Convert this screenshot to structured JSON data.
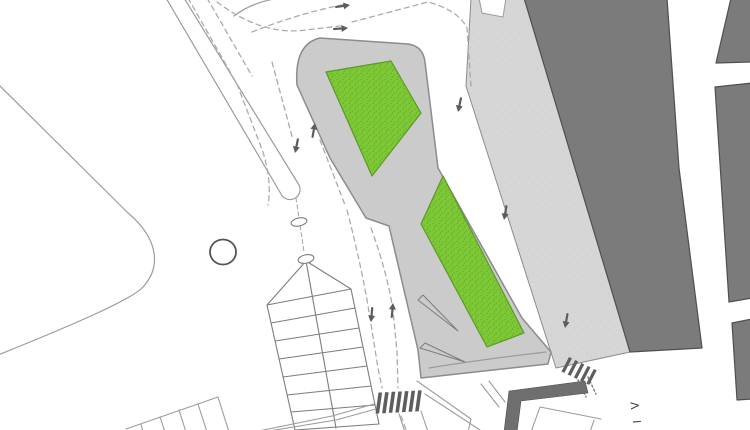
{
  "canvas": {
    "width": 750,
    "height": 430,
    "background": "#ffffff"
  },
  "labels": {
    "street_label": "VI"
  },
  "palette": {
    "white": "#ffffff",
    "plaza_gray": "#d6d6d6",
    "plaza_dot": "#c8c8c8",
    "island_gray": "#cbcbcb",
    "building_dark": "#7b7b7b",
    "building_edge": "#4f4f4f",
    "band_dark": "#6f6f6f",
    "green": "#7cc836",
    "green_stipple": "#68ad27",
    "green_edge": "#5c9a26",
    "line_gray": "#9c9c9c",
    "line_dark": "#7d7d7d",
    "outline_gray": "#8c8c8c",
    "dash_gray": "#ababab",
    "arrow_dark": "#5c5c5c",
    "stripe_dark": "#5e5e5e",
    "text_dark": "#3c3c3c"
  },
  "svg_elements": [
    {
      "name": "plaza-pavement",
      "type": "path",
      "d": "M 471,-2 L 527,-2 L 630,352 L 556,368 L 466,86 Z",
      "fill": "url(#plazafill)",
      "stroke": "@outline_gray",
      "width": 1
    },
    {
      "name": "plaza-top-notch",
      "type": "path",
      "d": "M 479,-2 L 482,13 L 503,17 L 506,-2 Z",
      "fill": "#ffffff",
      "stroke": "@line_gray",
      "width": 1
    },
    {
      "name": "building-main",
      "type": "path",
      "d": "M 524,-2 L 667,-2 L 679,168 L 702,348 L 630,352 Z",
      "fill": "@building_dark",
      "stroke": "@building_edge",
      "width": 1.2
    },
    {
      "name": "building-northeast",
      "type": "path",
      "d": "M 731,-2 L 752,-2 L 752,62 L 716,63 Z",
      "fill": "@building_dark",
      "stroke": "@building_edge",
      "width": 1.2
    },
    {
      "name": "building-east",
      "type": "path",
      "d": "M 715,87 L 752,83 L 752,298 L 729,302 Z",
      "fill": "@building_dark",
      "stroke": "@building_edge",
      "width": 1.2
    },
    {
      "name": "building-southeast",
      "type": "path",
      "d": "M 732,323 L 752,319 L 752,399 L 737,400 Z",
      "fill": "@building_dark",
      "stroke": "@building_edge",
      "width": 1.2
    },
    {
      "name": "traffic-island",
      "type": "path",
      "d": "M 320,38 L 408,44 Q 423,46 425,62 L 438,168 L 522,318 L 551,352 L 548,364 L 421,378 L 418,350 L 389,226 L 366,218 L 330,158 L 297,85 Q 294,44 320,38 Z",
      "fill": "@island_gray",
      "stroke": "@outline_gray",
      "width": 1.5
    },
    {
      "name": "green-area-upper",
      "type": "path",
      "d": "M 326,72 L 391,61 L 421,113 L 372,176 Z",
      "fill": "url(#greenfill)",
      "stroke": "@green_edge",
      "width": 1.2
    },
    {
      "name": "green-area-lower",
      "type": "path",
      "d": "M 443,176 L 421,224 L 487,347 L 524,333 Z",
      "fill": "url(#greenfill)",
      "stroke": "@green_edge",
      "width": 1.2
    },
    {
      "name": "plaza-curb-line",
      "type": "path",
      "d": "M 429,368 Q 478,360 546,352",
      "stroke": "@line_gray",
      "width": 1.2
    },
    {
      "name": "ramp-wedge-upper",
      "type": "path",
      "d": "M 418,300 L 423,295 L 458,331 Z",
      "stroke": "@line_dark",
      "width": 1
    },
    {
      "name": "ramp-wedge-lower",
      "type": "path",
      "d": "M 420,348 L 425,343 L 465,362 Z",
      "stroke": "@line_dark",
      "width": 1
    },
    {
      "name": "road-edge-finger",
      "type": "path",
      "d": "M -2,84 L 127,212 C 158,238 162,266 143,287 C 132,299 80,322 -2,355",
      "stroke": "@line_gray",
      "width": 1.2
    },
    {
      "name": "median-strip",
      "type": "path",
      "d": "M 166,-2 L 281,194 A 9.5,9.5 0 0 0 299,185 L 184,-2",
      "fill": "#ffffff",
      "stroke": "@line_gray",
      "width": 1.2
    },
    {
      "name": "road-corner-arc",
      "type": "path",
      "d": "M 234,16 Q 252,2 280,-2",
      "stroke": "@line_gray",
      "width": 1.2
    },
    {
      "name": "lane-dashed-left-outer",
      "type": "path",
      "d": "M 188,-2 L 237,84 L 263,152 Q 272,182 268,205",
      "stroke": "@dash_gray",
      "width": 1.3,
      "dash": "5 4"
    },
    {
      "name": "lane-dashed-left-inner",
      "type": "path",
      "d": "M 207,-2 L 252,76",
      "stroke": "@dash_gray",
      "width": 1.3,
      "dash": "5 4"
    },
    {
      "name": "turn-dashed-upper",
      "type": "path",
      "d": "M 252,32 Q 292,16 332,7 L 346,4",
      "stroke": "@dash_gray",
      "width": 1.3,
      "dash": "5 4"
    },
    {
      "name": "turn-dashed-lower",
      "type": "path",
      "d": "M 217,2 Q 262,36 306,30 L 340,26",
      "stroke": "@dash_gray",
      "width": 1.3,
      "dash": "5 4"
    },
    {
      "name": "top-right-dashed",
      "type": "path",
      "d": "M 352,22 L 428,2 Q 458,10 467,28 L 471,86",
      "stroke": "@dash_gray",
      "width": 1.3,
      "dash": "5 4"
    },
    {
      "name": "contraflow-dashed-down",
      "type": "path",
      "d": "M 272,62 L 293,140",
      "stroke": "@dash_gray",
      "width": 1.3,
      "dash": "5 4"
    },
    {
      "name": "contraflow-dashed-up",
      "type": "path",
      "d": "M 320,140 L 345,205",
      "stroke": "@dash_gray",
      "width": 1.3,
      "dash": "5 4"
    },
    {
      "name": "island-lane-dashed-down",
      "type": "path",
      "d": "M 347,210 Q 362,268 369,312 L 378,368 L 382,388",
      "stroke": "@dash_gray",
      "width": 1.3,
      "dash": "5 4"
    },
    {
      "name": "island-lane-dashed-up",
      "type": "path",
      "d": "M 371,228 Q 387,272 393,310 L 397,352 L 398,388",
      "stroke": "@dash_gray",
      "width": 1.3,
      "dash": "5 4"
    },
    {
      "name": "below-crosswalk-dashed",
      "type": "path",
      "d": "M 401,416 L 407,432",
      "stroke": "@dash_gray",
      "width": 1.3,
      "dash": "5 4"
    },
    {
      "name": "stairs-axis-dashed",
      "type": "path",
      "d": "M 296,198 L 304,252",
      "stroke": "@dash_gray",
      "width": 1.1,
      "dash": "4 3"
    },
    {
      "name": "small-crosswalk-dotted-a",
      "type": "path",
      "d": "M 578,380 L 586,397",
      "stroke": "@line_dark",
      "width": 1.4,
      "dash": "2 2.5"
    },
    {
      "name": "small-crosswalk-dotted-b",
      "type": "path",
      "d": "M 588,377 L 596,394",
      "stroke": "@line_dark",
      "width": 1.4,
      "dash": "2 2.5"
    },
    {
      "name": "stairs-structure",
      "type": "path",
      "d": "M 267,305 L 295,430 M 351,289 L 379,424 M 306,261 L 267,305 M 306,261 L 351,289 M 306,261 L 336,428 M 267,305 L 351,289 M 271,323 L 355,308 M 275,341 L 359,328 M 279,359 L 363,347 M 283,377 L 367,366 M 287,395 L 371,386 M 291,412 L 375,405 M 295,430 L 379,424",
      "stroke": "@line_dark",
      "width": 1.1
    },
    {
      "name": "parking-stalls",
      "type": "path",
      "d": "M 126,429 L 218,397 L 229,432 M 141,424 L 143,432 M 160,417 L 165,432 M 179,410 L 186,432 M 198,404 L 207,432",
      "stroke": "@line_gray",
      "width": 1.1
    },
    {
      "name": "road-edges-southwest",
      "type": "path",
      "d": "M 254,432 L 332,416 L 374,404 M 263,432 L 336,420 L 376,409",
      "stroke": "@line_gray",
      "width": 1.1
    },
    {
      "name": "road-edges-south",
      "type": "path",
      "d": "M 399,414 L 405,432 M 421,411 L 428,432",
      "stroke": "@line_gray",
      "width": 1.1
    },
    {
      "name": "road-edges-southeast",
      "type": "path",
      "d": "M 417,381 L 471,419 L 468,432 M 425,394 L 480,430",
      "stroke": "@line_gray",
      "width": 1.1
    },
    {
      "name": "ramp-lines-south",
      "type": "path",
      "d": "M 481,384 L 499,407 M 489,381 L 505,402",
      "stroke": "@line_gray",
      "width": 1.1
    },
    {
      "name": "building-outline-south",
      "type": "path",
      "d": "M 531,432 L 540,407 L 601,419 M 594,420 L 590,432",
      "stroke": "@line_gray",
      "width": 1.1
    },
    {
      "name": "wall-band-south",
      "type": "path",
      "d": "M 504,432 L 509,391 L 585,381 L 588,393 L 521,401 L 517,432 Z",
      "fill": "@band_dark",
      "stroke": "@building_edge",
      "width": 0.6
    },
    {
      "name": "crosswalk-main",
      "type": "stripes",
      "x": 378.5,
      "y": 392.5,
      "count": 7,
      "step": [
        6.6,
        -0.35
      ],
      "bar": [
        -3,
        21
      ],
      "widthv": [
        3.6,
        0
      ],
      "fill": "@stripe_dark"
    },
    {
      "name": "crosswalk-small",
      "type": "stripes",
      "x": 569,
      "y": 357,
      "count": 5,
      "step": [
        6.2,
        3.0
      ],
      "bar": [
        -7.5,
        14.5
      ],
      "widthv": [
        2.9,
        1.4
      ],
      "fill": "@stripe_dark"
    },
    {
      "name": "bollard-circle",
      "type": "ellipse",
      "cx": 223,
      "cy": 252,
      "rx": 13,
      "ry": 12.5,
      "fill": "#ffffff",
      "stroke": "#555555",
      "width": 1.8
    },
    {
      "name": "marker-oval-north",
      "type": "ellipse",
      "cx": 299,
      "cy": 222,
      "rx": 8,
      "ry": 4,
      "rot": -12,
      "fill": "#ffffff",
      "stroke": "@line_dark",
      "width": 1.1
    },
    {
      "name": "marker-oval-south",
      "type": "ellipse",
      "cx": 306,
      "cy": 259,
      "rx": 8,
      "ry": 4.2,
      "rot": -12,
      "fill": "#ffffff",
      "stroke": "@line_dark",
      "width": 1.1
    },
    {
      "name": "flow-arrow-east-1",
      "type": "arrow",
      "x": 350,
      "y": 5,
      "angle": -8
    },
    {
      "name": "flow-arrow-east-2",
      "type": "arrow",
      "x": 348,
      "y": 28,
      "angle": -4
    },
    {
      "name": "lane-arrow-south-1",
      "type": "arrow",
      "x": 458,
      "y": 112,
      "angle": 102
    },
    {
      "name": "lane-arrow-south-2",
      "type": "arrow",
      "x": 504,
      "y": 220,
      "angle": 100
    },
    {
      "name": "lane-arrow-south-3",
      "type": "arrow",
      "x": 565,
      "y": 328,
      "angle": 100
    },
    {
      "name": "contraflow-arrow-down",
      "type": "arrow",
      "x": 295,
      "y": 153,
      "angle": 102
    },
    {
      "name": "contraflow-arrow-up",
      "type": "arrow",
      "x": 315,
      "y": 123,
      "angle": -80
    },
    {
      "name": "island-lane-arrow-down",
      "type": "arrow",
      "x": 371,
      "y": 322,
      "angle": 95
    },
    {
      "name": "island-lane-arrow-up",
      "type": "arrow",
      "x": 393,
      "y": 303,
      "angle": -85
    },
    {
      "name": "street-label-v",
      "type": "text",
      "text": "V",
      "x": 639,
      "y": 409,
      "rot": -95,
      "size": 11
    },
    {
      "name": "street-label-i",
      "type": "text",
      "text": "I",
      "x": 641,
      "y": 423,
      "rot": -95,
      "size": 11
    }
  ]
}
